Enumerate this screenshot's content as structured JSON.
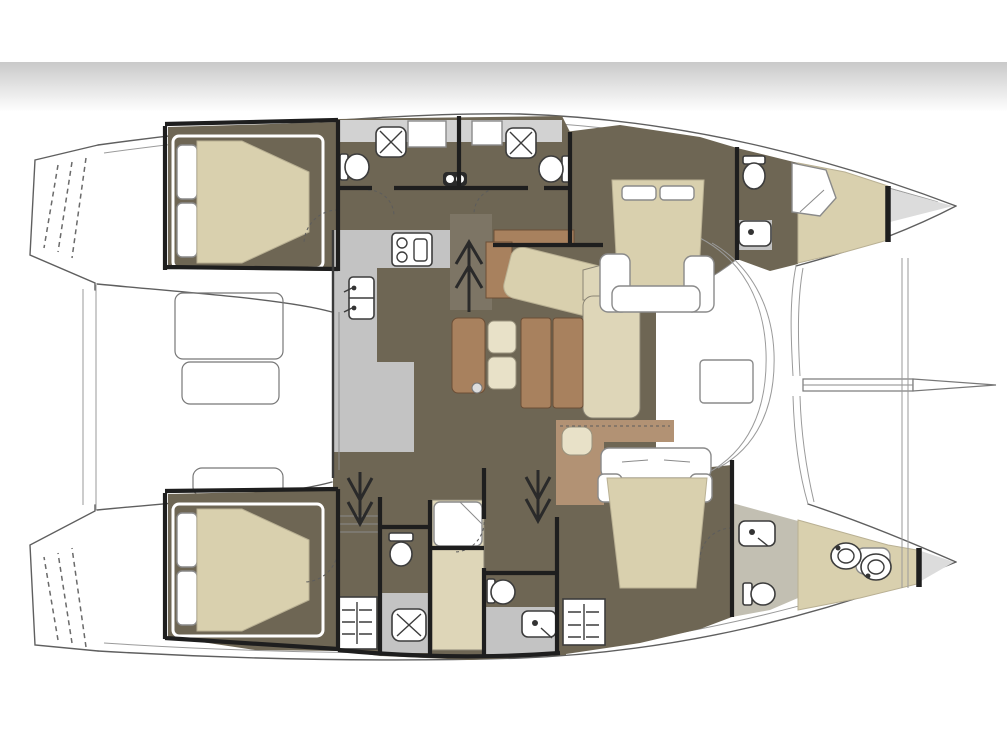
{
  "figure": {
    "type": "floor-plan",
    "subject": "Catamaran sailing yacht accommodation plan, top-down view, bow to the right",
    "orientation": "bow-right"
  },
  "palette": {
    "background": "#ffffff",
    "band_top": "#c9c9c9",
    "outline": "#5f5f5f",
    "outline_light": "#9a9a9a",
    "wall": "#1e1e1e",
    "floor_dark": "#6e6654",
    "floor_hatch_light": "#7d7565",
    "counter_gray": "#c3c3c3",
    "floor_gray_light": "#d2d2d2",
    "bath_olive": "#c2bfb2",
    "beige": "#d9d0ae",
    "beige_light": "#ded6b8",
    "stool_beige": "#e8e1c8",
    "wood": "#a8815e",
    "wood_light": "#b29274",
    "fixture_stroke": "#3c3c3c",
    "bow_gray": "#dcdcdc"
  },
  "hulls": {
    "port_top": {
      "rooms": [
        {
          "name": "aft double cabin",
          "furniture": [
            "double berth",
            "pillows",
            "white bed frame"
          ]
        },
        {
          "name": "aft en-suite bathroom",
          "fixtures": [
            "shower tray",
            "toilet",
            "vanity cabinet"
          ]
        },
        {
          "name": "mid en-suite bathroom",
          "fixtures": [
            "shower tray",
            "toilet",
            "twin washbasins"
          ]
        },
        {
          "name": "forward double cabin",
          "furniture": [
            "double berth",
            "nightstands",
            "foot frame"
          ]
        },
        {
          "name": "forward bathroom",
          "fixtures": [
            "toilet",
            "washbasin",
            "shower stall"
          ]
        },
        {
          "name": "forepeak berth",
          "furniture": [
            "v-berth cushion"
          ]
        }
      ]
    },
    "starboard_bottom": {
      "rooms": [
        {
          "name": "aft double cabin",
          "furniture": [
            "double berth",
            "pillows",
            "white bed frame"
          ]
        },
        {
          "name": "companionway stairs",
          "fixtures": [
            "steps",
            "down arrow"
          ]
        },
        {
          "name": "aft bathroom",
          "fixtures": [
            "toilet",
            "shower tray",
            "louver vent"
          ]
        },
        {
          "name": "corridor with shelf",
          "fixtures": [
            "shelf unit"
          ]
        },
        {
          "name": "mid bathroom",
          "fixtures": [
            "toilet",
            "washbasin",
            "louver vent"
          ]
        },
        {
          "name": "forward double cabin",
          "furniture": [
            "double berth",
            "headboard",
            "nightstands"
          ]
        },
        {
          "name": "forward bathroom",
          "fixtures": [
            "washbasin",
            "toilet"
          ]
        },
        {
          "name": "forepeak",
          "fixtures": [
            "twin wash bowls"
          ]
        }
      ]
    }
  },
  "bridge_deck": {
    "galley": {
      "fixtures": [
        "l-shaped counter",
        "two-burner stove with oven",
        "double sink with taps"
      ]
    },
    "salon": {
      "furniture": [
        "bench",
        "two stools",
        "two-part dining table",
        "l-shaped sofa",
        "angled chaise",
        "sideboard",
        "small pouf",
        "aft cabinet"
      ]
    },
    "companionway_arrows": [
      "up into salon",
      "down to port hull",
      "down to starboard hull"
    ],
    "windshield": {
      "fixtures": [
        "curved coachroof front",
        "deck hatch"
      ]
    }
  },
  "exterior": {
    "cockpit": {
      "furniture": [
        "cockpit table",
        "cockpit bench",
        "aft bench"
      ]
    },
    "stern": {
      "fixtures": [
        "port swim-step wedge",
        "starboard swim-step wedge",
        "transom platform rails"
      ]
    },
    "bow": {
      "fixtures": [
        "bowsprit",
        "forestay lines",
        "forward crossbeam curves",
        "bow lockers"
      ]
    }
  }
}
